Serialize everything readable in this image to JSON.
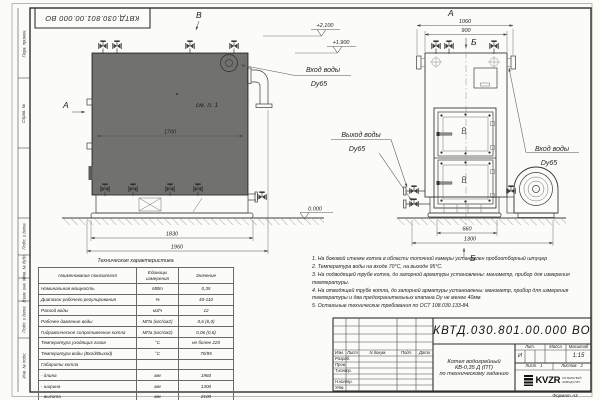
{
  "frame": {
    "stamp_top": "КВТД.030.801.00.000 ВО",
    "left_labels": [
      "Перв. примен.",
      "Справ. №",
      "Подп. и дата",
      "Инв. № дубл.",
      "Взам. инв. №",
      "Подп. и дата",
      "Инв. № подл."
    ]
  },
  "side": {
    "view_label": "В",
    "arrow_label": "А",
    "ref_note": "см. п. 1",
    "dim1": "1700",
    "dim2": "1830",
    "dim3": "1960",
    "elev1": "+2.100",
    "elev2": "+1.900",
    "elev0": "0.000",
    "inlet": "Вход воды",
    "inlet_dn": "Dy65",
    "outlet": "Выход воды",
    "outlet_dn": "Dy65"
  },
  "front": {
    "view_label": "А",
    "section": "Б",
    "dim_overall": "1060",
    "dim_inner": "900",
    "dim_base": "660",
    "dim_depth": "1300",
    "inlet": "Вход воды",
    "inlet_dn": "Dy65"
  },
  "spec_table": {
    "title": "Техническая характеристика",
    "col_name": "Наименование показателя",
    "col_units": "Единицы измерения",
    "col_value": "Значение",
    "rows": [
      {
        "name": "Номинальная мощность",
        "units": "МВт",
        "value": "0,35"
      },
      {
        "name": "Диапазон рабочего регулирования",
        "units": "%",
        "value": "40-110"
      },
      {
        "name": "Расход воды",
        "units": "м3/ч",
        "value": "12"
      },
      {
        "name": "Рабочее давление воды",
        "units": "МПа (кгс/см2)",
        "value": "0,6 (6,0)"
      },
      {
        "name": "Гидравлическое сопротивление котла",
        "units": "МПа (кгс/см2)",
        "value": "0,06 (0,6)"
      },
      {
        "name": "Температура уходящих газов",
        "units": "°С",
        "value": "не более 220"
      },
      {
        "name": "Температура воды (Вход/Выход)",
        "units": "°С",
        "value": "70/95"
      },
      {
        "name": "Габариты котла",
        "units": "",
        "value": ""
      },
      {
        "name": "- длина",
        "units": "мм",
        "value": "1960"
      },
      {
        "name": "- ширина",
        "units": "мм",
        "value": "1300"
      },
      {
        "name": "- высота",
        "units": "мм",
        "value": "2100"
      }
    ]
  },
  "notes": {
    "items": [
      "1.  На боковой стенке котла в области топочной камеры установлен пробоотборный штуцер",
      "2.  Температура воды на входе 70°С, на выходе 95°С.",
      "3.  На подводящей трубе котла, до запорной арматуры установлены: манометр, прибор для измерения температуры.",
      "4.  На отводящей трубе котла, до запорной арматуры установлены: манометр, прибор для измерения температуры и два предохранительных клапана Dу не менее 40мм.",
      "5.  Остальные технические требования по ОСТ 108.030.133-84."
    ]
  },
  "tb": {
    "doc_number": "КВТД.030.801.00.000  ВО",
    "title_line1": "Котел водогрейный",
    "title_line2": "КВ-0,35 Д (ПТ)",
    "title_line3": "по техническому заданию",
    "col_izm": "Изм.",
    "col_list": "Лист",
    "col_doc": "N докум.",
    "col_podp": "Подп.",
    "col_data": "Дата",
    "row1": "Разраб.",
    "row2": "Пров.",
    "row3": "Т.контр.",
    "row4": "Н.контр.",
    "row5": "Утв.",
    "lit_header": "Лит.",
    "mass_header": "Масса",
    "scale_header": "Масштаб",
    "lit_value": "И",
    "scale_value": "1:15",
    "sheet_label": "Лист",
    "sheet_value": "1",
    "sheets_label": "Листов",
    "sheets_value": "2",
    "logo_text": "KVZR",
    "logo_cap1": "КОТЕЛЬНЫЙ",
    "logo_cap2": "ЗАВОД РЭП",
    "format": "Формат А3"
  }
}
